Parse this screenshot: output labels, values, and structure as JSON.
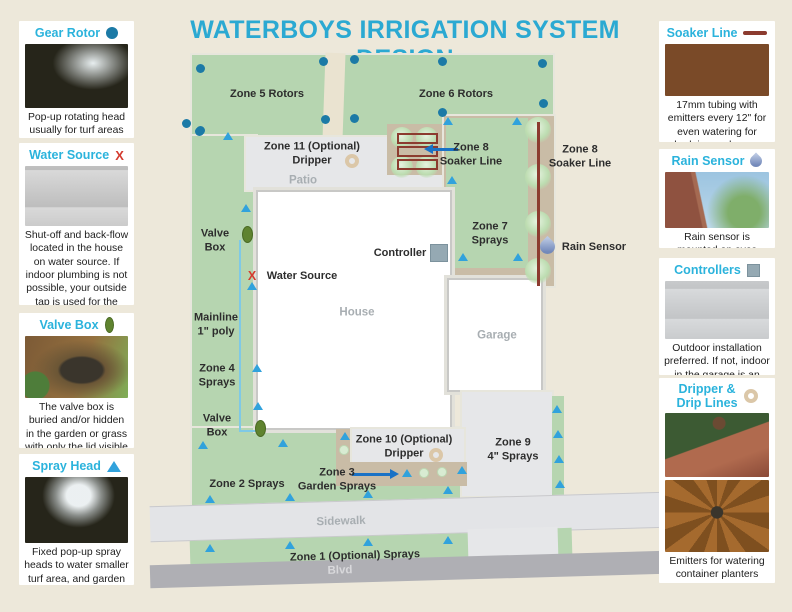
{
  "title": "WATERBOYS IRRIGATION SYSTEM DESIGN",
  "colors": {
    "background": "#EDE8DA",
    "accent": "#2BA9D2",
    "legend_heading": "#2BB3DC",
    "lawn": "#B6D5B0",
    "path": "#EAE3D0",
    "paved": "#E6E7E9",
    "tan": "#C9BCA6",
    "building": "#FFFFFF",
    "sidewalk": "#E3E4E7",
    "blvd": "#AFAFB4",
    "rotor": "#1C7AA6",
    "spray": "#31A2DC",
    "valve": "#5F832F",
    "soaker": "#8C3B2F",
    "mainline": "#7FC9E6",
    "arrow": "#1A72C6",
    "controller": "#95A9B3",
    "dripper_ring": "#DBC7A8",
    "x_mark": "#D43B2F"
  },
  "legend_left": [
    {
      "title": "Gear Rotor",
      "icon": "gear-rotor-icon",
      "icon_kind": "dot",
      "images": [
        "img-sprinkler-lawn"
      ],
      "description": "Pop-up rotating head usually for turf areas"
    },
    {
      "title": "Water Source",
      "icon": "water-source-x-icon",
      "icon_kind": "x",
      "icon_text": "X",
      "images": [
        "img-brick-pipes"
      ],
      "description": "Shut-off and back-flow located in the house on water source. If indoor plumbing is not possible, your outside tap is used for the water source"
    },
    {
      "title": "Valve Box",
      "icon": "valve-box-icon",
      "icon_kind": "oval",
      "images": [
        "img-valve-soil"
      ],
      "description": "The valve box is buried and/or hidden in the garden or grass with only the lid visible"
    },
    {
      "title": "Spray Head",
      "icon": "spray-head-icon",
      "icon_kind": "tri",
      "images": [
        "img-spray-grass"
      ],
      "description": "Fixed pop-up spray heads to water smaller turf area, and garden beds"
    }
  ],
  "legend_right": [
    {
      "title": "Soaker Line",
      "icon": "soaker-line-icon",
      "icon_kind": "bar",
      "images": [
        "img-soaker-bed"
      ],
      "description": "17mm tubing with emitters every 12\" for even watering for hedging and some garden beds"
    },
    {
      "title": "Rain Sensor",
      "icon": "rain-sensor-icon",
      "icon_kind": "drop",
      "images": [
        "img-brick-sky"
      ],
      "description": "Rain sensor is mounted on eves trough or fence"
    },
    {
      "title": "Controllers",
      "icon": "controller-icon",
      "icon_kind": "square",
      "images": [
        "img-controllers"
      ],
      "description": "Outdoor installation preferred. If not, indoor in the garage is an option"
    },
    {
      "title": "Dripper &\nDrip Lines",
      "icon": "dripper-icon",
      "icon_kind": "ring",
      "images": [
        "img-planter",
        "img-dripline"
      ],
      "description": "Emitters for watering container planters"
    }
  ],
  "map": {
    "regions": [
      {
        "name": "backyard-lawn",
        "x": 192,
        "y": 55,
        "w": 361,
        "h": 83,
        "fill": "lawn",
        "cls": "rim"
      },
      {
        "name": "garden-path",
        "x": 324,
        "y": 53,
        "w": 20,
        "h": 87,
        "fill": "path",
        "rot": 2
      },
      {
        "name": "left-lawn-strip",
        "x": 192,
        "y": 136,
        "w": 64,
        "h": 334,
        "fill": "lawn",
        "cls": "rim"
      },
      {
        "name": "front-lawn",
        "x": 192,
        "y": 428,
        "w": 272,
        "h": 80,
        "fill": "lawn",
        "cls": "rim"
      },
      {
        "name": "patio",
        "x": 246,
        "y": 137,
        "w": 200,
        "h": 53,
        "fill": "paved",
        "cls": "rim"
      },
      {
        "name": "right-garden-bed",
        "x": 444,
        "y": 116,
        "w": 110,
        "h": 170,
        "fill": "tan",
        "cls": "rim"
      },
      {
        "name": "zone7-lawn",
        "x": 446,
        "y": 118,
        "w": 82,
        "h": 150,
        "fill": "lawn"
      },
      {
        "name": "zone8-bed",
        "x": 387,
        "y": 124,
        "w": 55,
        "h": 51,
        "fill": "tan"
      },
      {
        "name": "house",
        "x": 256,
        "y": 190,
        "w": 196,
        "h": 240,
        "fill": "building",
        "cls": "building"
      },
      {
        "name": "garage",
        "x": 447,
        "y": 278,
        "w": 96,
        "h": 114,
        "fill": "building",
        "cls": "building"
      },
      {
        "name": "driveway",
        "x": 462,
        "y": 392,
        "w": 90,
        "h": 104,
        "fill": "paved",
        "cls": "rim"
      },
      {
        "name": "zone9-lawn-strip",
        "x": 552,
        "y": 396,
        "w": 12,
        "h": 100,
        "fill": "lawn"
      },
      {
        "name": "bottom-bed-left",
        "x": 336,
        "y": 429,
        "w": 16,
        "h": 57,
        "fill": "tan"
      },
      {
        "name": "zone10-box",
        "x": 352,
        "y": 429,
        "w": 112,
        "h": 33,
        "fill": "paved",
        "cls": "rim"
      },
      {
        "name": "bottom-bed",
        "x": 336,
        "y": 462,
        "w": 131,
        "h": 24,
        "fill": "tan"
      },
      {
        "name": "sidewalk",
        "x": 150,
        "y": 499,
        "w": 516,
        "h": 36,
        "fill": "sidewalk",
        "cls": "band",
        "rot": -1.6
      },
      {
        "name": "zone1-lawn-strip",
        "x": 190,
        "y": 537,
        "w": 282,
        "h": 26,
        "fill": "lawn",
        "rot": -1.6
      },
      {
        "name": "zone1-lawn-strip-right",
        "x": 556,
        "y": 528,
        "w": 16,
        "h": 30,
        "fill": "lawn",
        "rot": -1.6
      },
      {
        "name": "driveway-apron",
        "x": 468,
        "y": 528,
        "w": 90,
        "h": 34,
        "fill": "paved",
        "rot": -1.6
      },
      {
        "name": "blvd-road",
        "x": 150,
        "y": 558,
        "w": 516,
        "h": 23,
        "fill": "blvd",
        "rot": -1.6
      }
    ],
    "labels": [
      {
        "text": "Zone 5 Rotors",
        "x": 267,
        "y": 94,
        "kind": "zone"
      },
      {
        "text": "Zone 6 Rotors",
        "x": 456,
        "y": 94,
        "kind": "zone"
      },
      {
        "text": "Zone 11 (Optional)\nDripper",
        "x": 312,
        "y": 154,
        "kind": "zone"
      },
      {
        "text": "Patio",
        "x": 303,
        "y": 181,
        "kind": "area"
      },
      {
        "text": "Zone 8\nSoaker Line",
        "x": 471,
        "y": 155,
        "kind": "zone"
      },
      {
        "text": "Zone 8\nSoaker Line",
        "x": 580,
        "y": 157,
        "kind": "zone"
      },
      {
        "text": "Zone 7\nSprays",
        "x": 490,
        "y": 234,
        "kind": "zone"
      },
      {
        "text": "Valve\nBox",
        "x": 215,
        "y": 241,
        "kind": "zone"
      },
      {
        "text": "Controller",
        "x": 400,
        "y": 253,
        "kind": "zone"
      },
      {
        "text": "Rain Sensor",
        "x": 594,
        "y": 247,
        "kind": "zone"
      },
      {
        "text": "X",
        "x": 252,
        "y": 276,
        "kind": "xmark"
      },
      {
        "text": "Water Source",
        "x": 302,
        "y": 276,
        "kind": "zone"
      },
      {
        "text": "House",
        "x": 357,
        "y": 313,
        "kind": "area"
      },
      {
        "text": "Garage",
        "x": 497,
        "y": 336,
        "kind": "area"
      },
      {
        "text": "Mainline\n1\" poly",
        "x": 216,
        "y": 325,
        "kind": "zone"
      },
      {
        "text": "Zone 4\nSprays",
        "x": 217,
        "y": 376,
        "kind": "zone"
      },
      {
        "text": "Valve\nBox",
        "x": 217,
        "y": 426,
        "kind": "zone"
      },
      {
        "text": "Zone 10 (Optional)\nDripper",
        "x": 404,
        "y": 447,
        "kind": "zone"
      },
      {
        "text": "Zone 9\n4\" Sprays",
        "x": 513,
        "y": 450,
        "kind": "zone"
      },
      {
        "text": "Zone 2 Sprays",
        "x": 247,
        "y": 484,
        "kind": "zone"
      },
      {
        "text": "Zone 3\nGarden Sprays",
        "x": 337,
        "y": 480,
        "kind": "zone"
      },
      {
        "text": "Sidewalk",
        "x": 341,
        "y": 522,
        "kind": "area",
        "rot": -1.6
      },
      {
        "text": "Zone 1 (Optional) Sprays",
        "x": 355,
        "y": 556,
        "kind": "zone",
        "rot": -1.6
      },
      {
        "text": "Blvd",
        "x": 340,
        "y": 571,
        "kind": "blvd",
        "rot": -1.6
      }
    ],
    "markers": {
      "rotors": [
        [
          200,
          68
        ],
        [
          323,
          61
        ],
        [
          354,
          59
        ],
        [
          442,
          61
        ],
        [
          542,
          63
        ],
        [
          200,
          130
        ],
        [
          325,
          119
        ],
        [
          186,
          123
        ],
        [
          199,
          131
        ],
        [
          354,
          118
        ],
        [
          442,
          112
        ],
        [
          543,
          103
        ]
      ],
      "sprays": [
        [
          228,
          136
        ],
        [
          246,
          208
        ],
        [
          252,
          286
        ],
        [
          257,
          368
        ],
        [
          258,
          406
        ],
        [
          203,
          445
        ],
        [
          283,
          443
        ],
        [
          210,
          499
        ],
        [
          290,
          497
        ],
        [
          368,
          494
        ],
        [
          448,
          490
        ],
        [
          210,
          548
        ],
        [
          290,
          545
        ],
        [
          368,
          542
        ],
        [
          448,
          540
        ],
        [
          448,
          121
        ],
        [
          452,
          180
        ],
        [
          517,
          121
        ],
        [
          463,
          257
        ],
        [
          518,
          257
        ],
        [
          345,
          436
        ],
        [
          407,
          473
        ],
        [
          462,
          470
        ],
        [
          557,
          409
        ],
        [
          558,
          434
        ],
        [
          559,
          459
        ],
        [
          560,
          484
        ]
      ],
      "valves": [
        [
          247,
          234
        ],
        [
          260,
          428
        ]
      ],
      "rings": [
        [
          352,
          161
        ],
        [
          436,
          455
        ]
      ],
      "emitters": [
        [
          344,
          450
        ],
        [
          424,
          473
        ],
        [
          442,
          472
        ]
      ],
      "bushes": [
        [
          402,
          138,
          11
        ],
        [
          427,
          138,
          11
        ],
        [
          402,
          167,
          11
        ],
        [
          427,
          167,
          11
        ],
        [
          538,
          130,
          13
        ],
        [
          538,
          177,
          13
        ],
        [
          538,
          224,
          13
        ],
        [
          538,
          271,
          13
        ]
      ]
    },
    "soaker_loops": [
      [
        397,
        133,
        41,
        11
      ],
      [
        397,
        146,
        41,
        11
      ],
      [
        397,
        159,
        41,
        11
      ]
    ],
    "soaker_vline": {
      "x": 537,
      "y": 122,
      "h": 164
    },
    "mainline_segments": [
      [
        239,
        240,
        2,
        192
      ],
      [
        239,
        430,
        20,
        2
      ]
    ],
    "arrows": [
      {
        "name": "zone8-pointer-arrow",
        "x": 424,
        "y": 149,
        "len": 34,
        "dir": "left"
      },
      {
        "name": "zone3-pointer-arrow",
        "x": 352,
        "y": 474,
        "len": 47,
        "dir": "right"
      }
    ],
    "controller_box": {
      "x": 430,
      "y": 244,
      "w": 18,
      "h": 18
    },
    "raindrop": {
      "x": 540,
      "y": 239
    }
  }
}
